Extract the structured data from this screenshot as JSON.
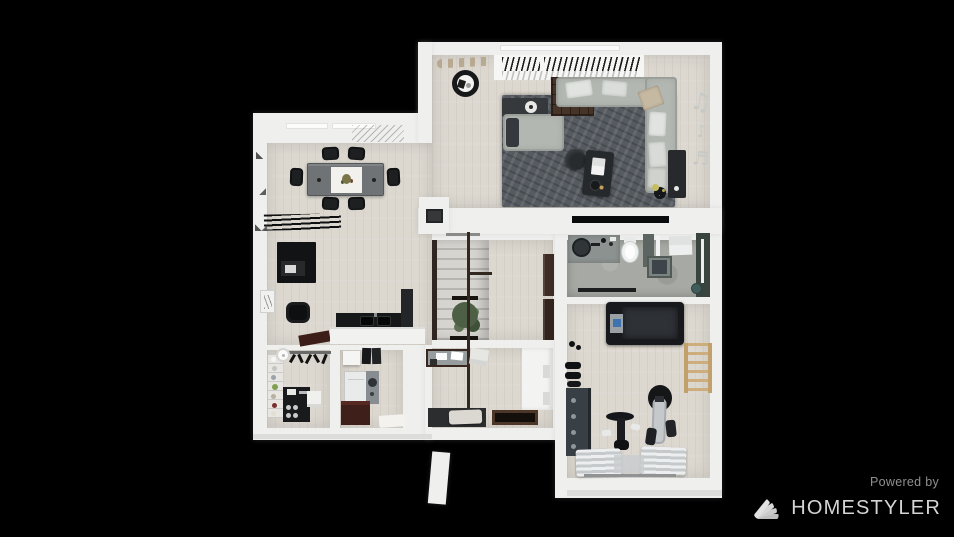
{
  "canvas": {
    "width": 954,
    "height": 537,
    "background": "#000000"
  },
  "watermark": {
    "powered_by": "Powered by",
    "brand": "HOMESTYLER",
    "logo_icon": "swatch-fan-icon",
    "powered_by_color": "#8f8f8f",
    "brand_color": "#d5d5d5"
  },
  "decor": {
    "music_wall_decal_glyphs": [
      "♫",
      "♪",
      "♬"
    ]
  },
  "palette": {
    "background": "#000000",
    "walls": "#efefee",
    "wood_floor": "#dcd8d0",
    "concrete_floor": "#a7aaa4",
    "area_rug": "#565b61",
    "sofa": "#b2b7b1",
    "dark_furniture": "#17181a",
    "wood_accent": "#c2a06c",
    "maroon_cabinet": "#3f1f19",
    "plant_green": "#4d5f45"
  },
  "floorplan": {
    "view": "top-down 3D rendered floor plan",
    "rooms": [
      {
        "name": "living-room",
        "furniture": [
          "sectional-sofa",
          "daybed",
          "coffee-table",
          "round-pouf",
          "area-rug",
          "bookshelf-cabinet",
          "console-table",
          "round-side-table",
          "wall-tv-strip",
          "media-sideboard",
          "corner-plant",
          "pergola-slats",
          "branch-wall-decor",
          "music-notes-wall-decal"
        ]
      },
      {
        "name": "dining-room",
        "furniture": [
          "dining-table",
          "white-table-runner-with-flowers",
          "six-black-chairs",
          "slatted-bench",
          "black-sideboard",
          "lounge-stool",
          "wall-art"
        ]
      },
      {
        "name": "kitchen-corner",
        "furniture": [
          "black-counter-with-double-sink",
          "tall-dark-cabinet",
          "white-island-counter"
        ]
      },
      {
        "name": "stair-room",
        "furniture": [
          "staircase",
          "handrail-pole",
          "potted-plant",
          "wall-cabinets"
        ]
      },
      {
        "name": "entry-hall",
        "furniture": [
          "glass-console",
          "white-wardrobe",
          "entry-door-mat",
          "lamp-base-plate",
          "envelope-decor"
        ]
      },
      {
        "name": "bathroom",
        "furniture": [
          "vanity-with-round-basin",
          "toilet",
          "shower-tray",
          "glass-partition",
          "towels",
          "dark-accent-wall",
          "bucket"
        ]
      },
      {
        "name": "home-gym",
        "furniture": [
          "treadmill",
          "exercise-bike",
          "elliptical-trainer",
          "dumbbell-rack",
          "dumbbells",
          "wooden-wall-bars",
          "exercise-mats"
        ]
      },
      {
        "name": "pantry",
        "furniture": [
          "shelving-with-jars",
          "coffee-station",
          "hanging-utensil-rack",
          "ceiling-lamp",
          "storage-cube"
        ]
      },
      {
        "name": "laundry-room",
        "furniture": [
          "washing-machine",
          "maroon-cabinet",
          "wall-shelf-box",
          "hanging-towels",
          "white-floor-mat"
        ]
      }
    ]
  }
}
